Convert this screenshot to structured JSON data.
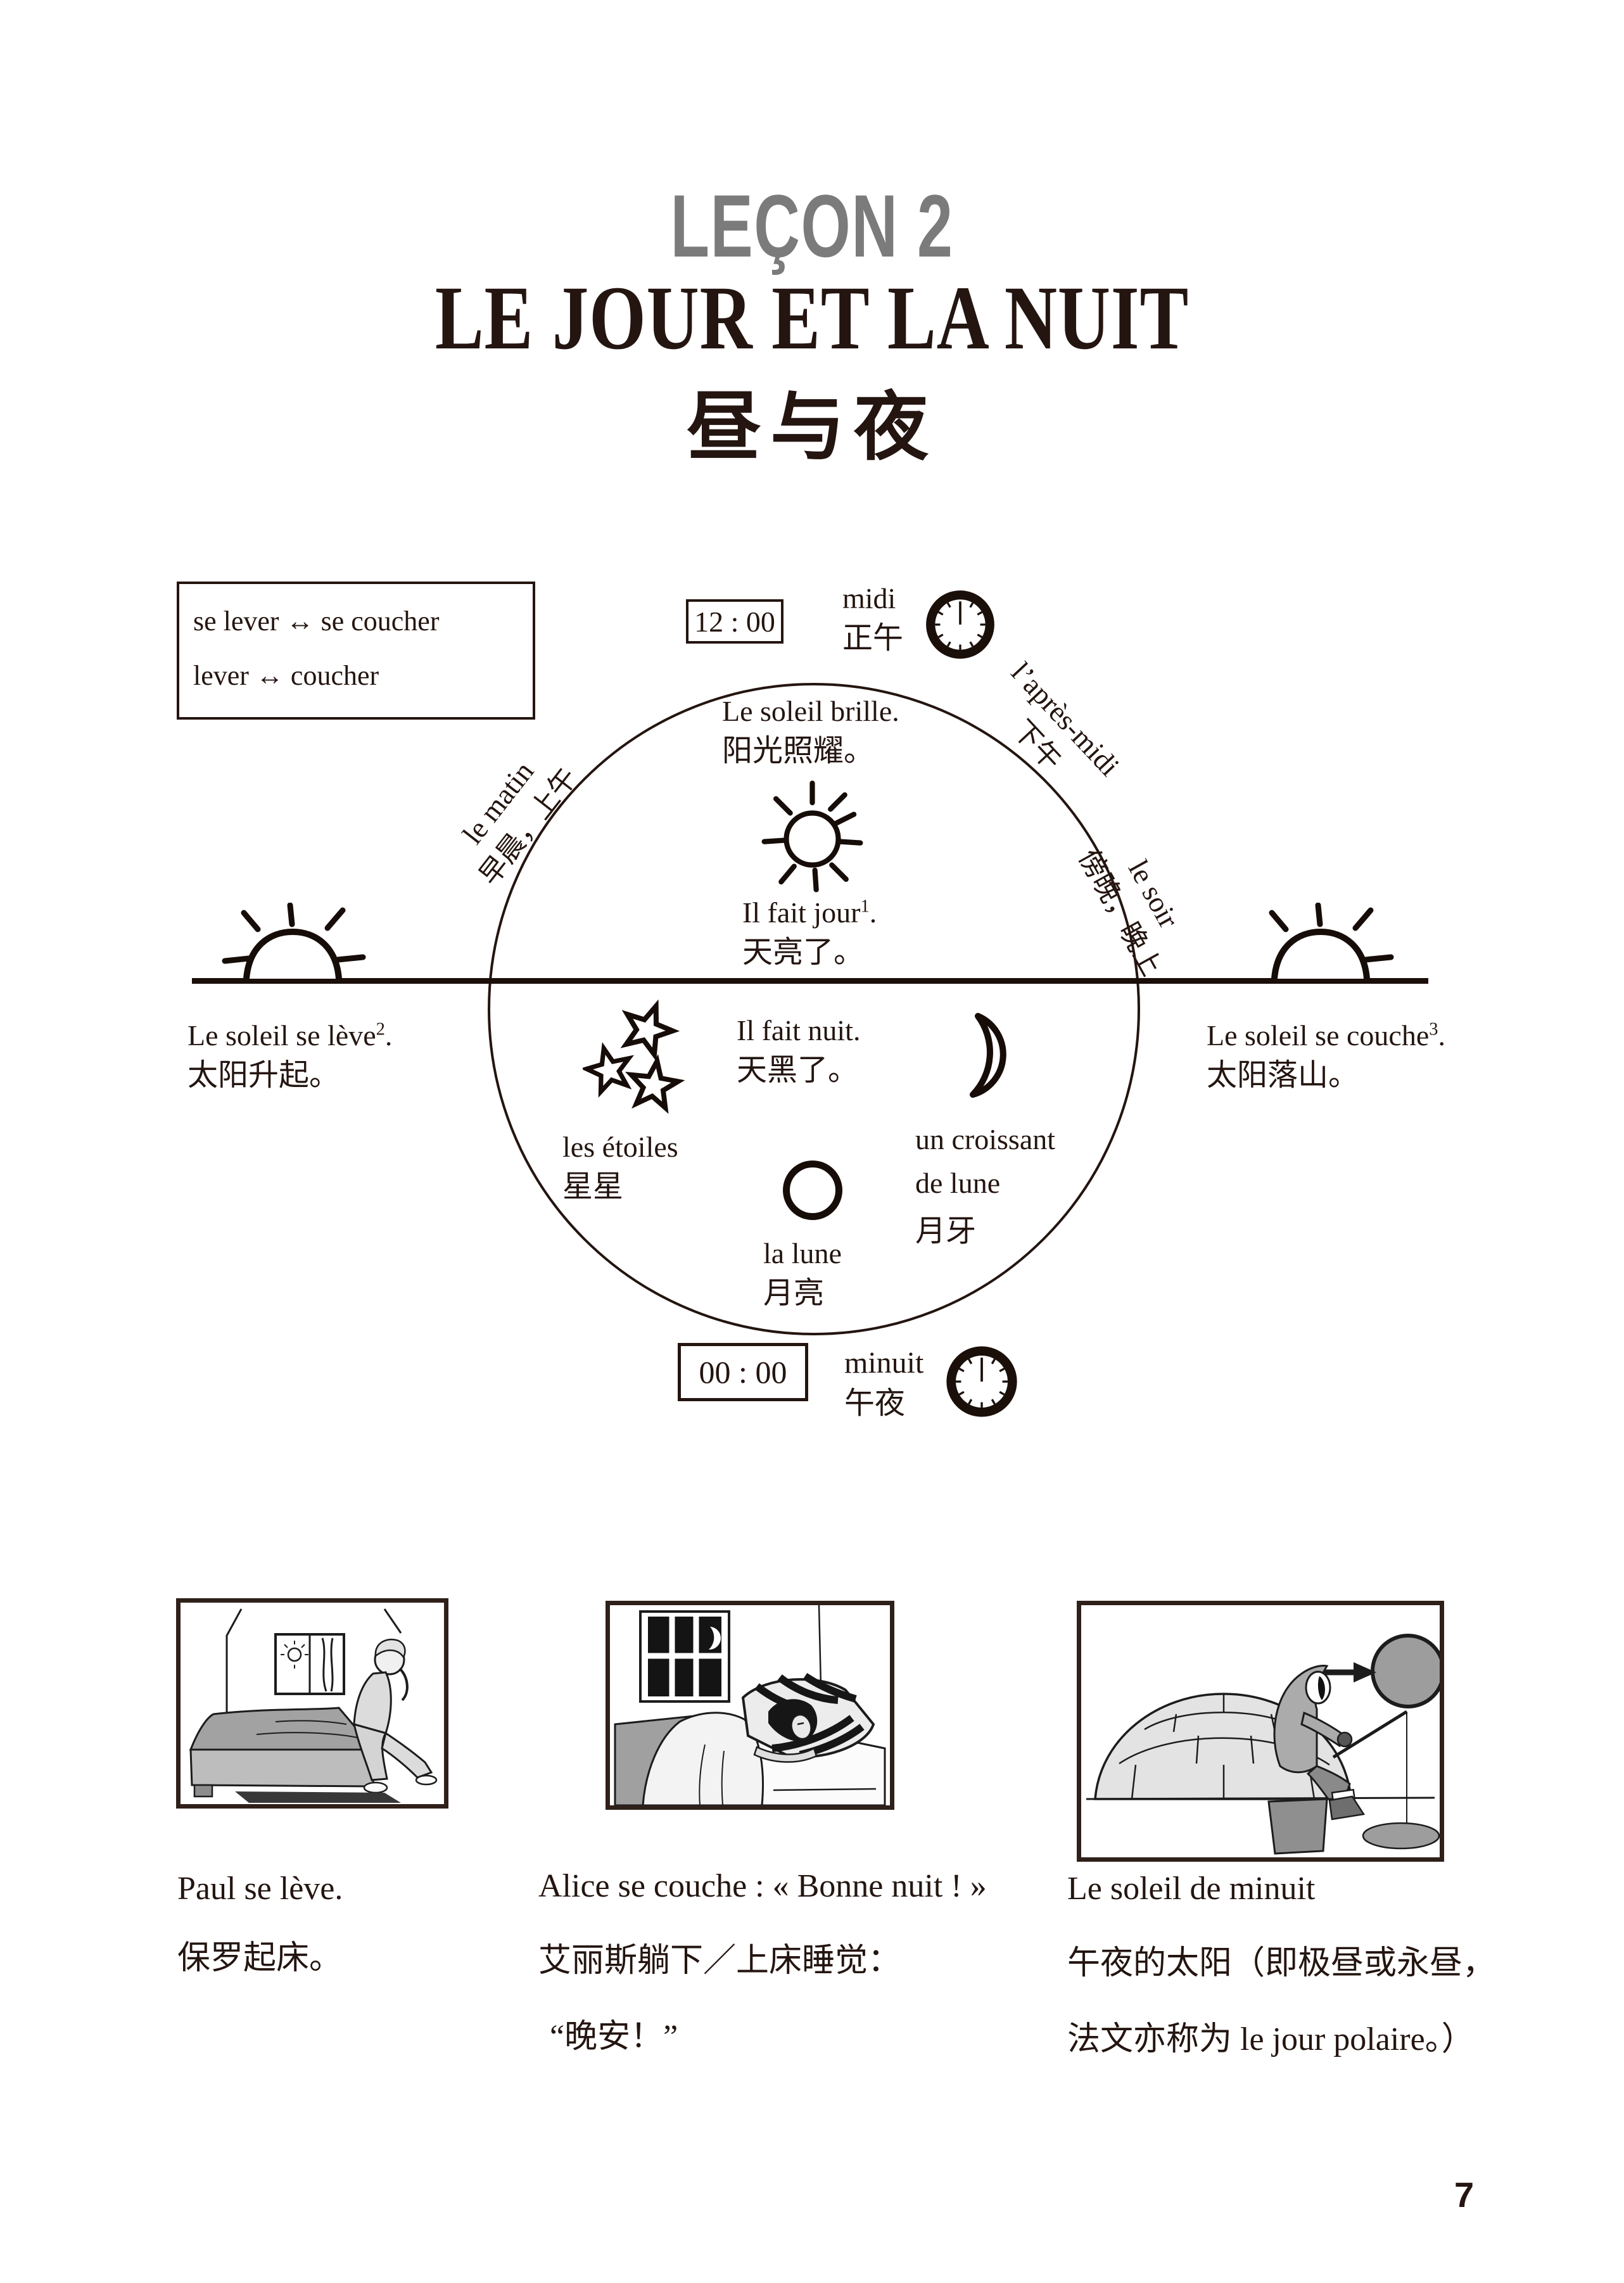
{
  "header": {
    "lesson_label": "LEÇON 2",
    "title_fr": "LE JOUR ET LA NUIT",
    "title_zh": "昼与夜"
  },
  "vocab_box": {
    "line1": "se lever ↔ se coucher",
    "line2": "lever ↔ coucher"
  },
  "diagram": {
    "midi": {
      "time": "12 : 00",
      "label_fr": "midi",
      "label_zh": "正午"
    },
    "minuit": {
      "time": "00 : 00",
      "label_fr": "minuit",
      "label_zh": "午夜"
    },
    "matin": {
      "fr": "le matin",
      "zh": "早晨，上午"
    },
    "apres_midi": {
      "fr": "l’après-midi",
      "zh": "下午"
    },
    "soir": {
      "fr": "le soir",
      "zh": "傍晚，晚上"
    },
    "brille": {
      "fr": "Le soleil brille.",
      "zh": "阳光照耀。"
    },
    "jour": {
      "fr": "Il fait jour",
      "sup": "1",
      "dot": ".",
      "zh": "天亮了。"
    },
    "nuit": {
      "fr": "Il fait nuit.",
      "zh": "天黑了。"
    },
    "etoiles": {
      "fr": "les étoiles",
      "zh": "星星"
    },
    "croissant": {
      "fr_line1": "un croissant",
      "fr_line2": "de lune",
      "zh": "月牙"
    },
    "lune": {
      "fr": "la lune",
      "zh": "月亮"
    },
    "leve": {
      "fr": "Le soleil se lève",
      "sup": "2",
      "dot": ".",
      "zh": "太阳升起。"
    },
    "couche": {
      "fr": "Le soleil se couche",
      "sup": "3",
      "dot": ".",
      "zh": "太阳落山。"
    }
  },
  "figures": {
    "paul": {
      "caption_fr": "Paul se lève.",
      "caption_zh": "保罗起床。"
    },
    "alice": {
      "caption_fr": "Alice se couche : « Bonne nuit ! »",
      "caption_zh_line1": "艾丽斯躺下／上床睡觉：",
      "caption_zh_line2": "“晚安！”"
    },
    "minuit_sun": {
      "caption_fr": "Le soleil de minuit",
      "caption_zh_line1": "午夜的太阳（即极昼或永昼，",
      "caption_zh_line2": "法文亦称为 le jour polaire。）"
    }
  },
  "page_number": "7",
  "colors": {
    "ink": "#241510",
    "lesson_gray": "#7b7b7b",
    "figure_border": "#30201a"
  }
}
